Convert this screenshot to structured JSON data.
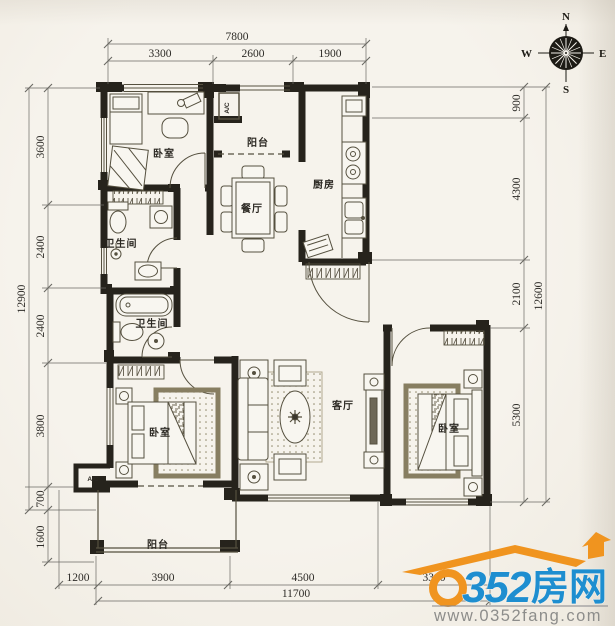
{
  "compass": {
    "n": "N",
    "e": "E",
    "s": "S",
    "w": "W"
  },
  "rooms": {
    "bedroom_top": "卧室",
    "bedroom_left": "卧室",
    "bedroom_right": "卧室",
    "balcony_top": "阳台",
    "balcony_bottom": "阳台",
    "kitchen": "厨房",
    "dining": "餐厅",
    "bathroom_upper": "卫生间",
    "bathroom_lower": "卫生间",
    "living": "客厅"
  },
  "labels": {
    "ac_top": "A/C",
    "ac_bottom": "A/C"
  },
  "dimensions": {
    "top": {
      "total": "7800",
      "seg1": "3300",
      "seg2": "2600",
      "seg3": "1900"
    },
    "left": {
      "seg1": "3600",
      "seg2": "2400",
      "seg3": "2400",
      "seg4": "3800",
      "seg5": "700",
      "seg6": "1600",
      "total": "12900"
    },
    "right": {
      "seg1": "900",
      "seg2": "4300",
      "seg3": "2100",
      "seg4": "5300",
      "total": "12600"
    },
    "bottom": {
      "seg1": "1200",
      "seg2": "3900",
      "seg3": "4500",
      "seg4": "3300",
      "total": "11700"
    }
  },
  "logo": {
    "digit_zero": "0",
    "digits": "352",
    "cn": "房网",
    "website": "www.0352fang.com",
    "blue": "#1e8ed0",
    "orange": "#f0941f"
  },
  "colors": {
    "wall": "#26231c",
    "paper": "#f4f1ea"
  }
}
